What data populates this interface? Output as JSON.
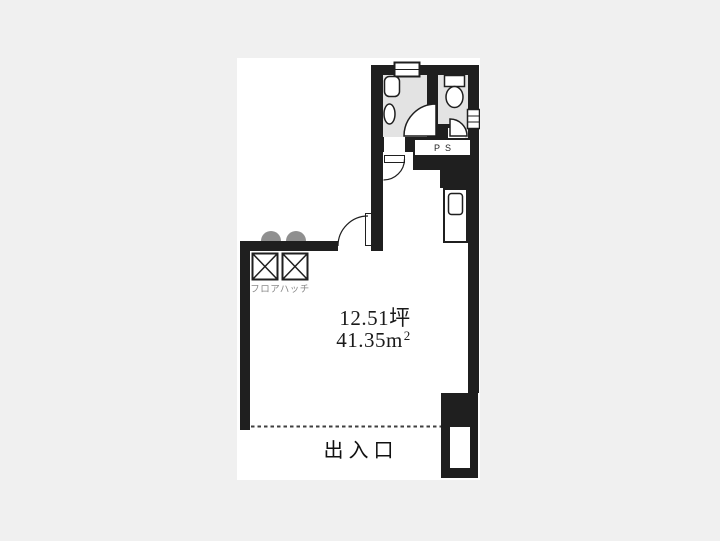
{
  "floorplan": {
    "area": {
      "tsubo_value": "12.51",
      "tsubo_unit": "坪",
      "sqm_value": "41.35",
      "sqm_unit_base": "m",
      "sqm_unit_sup": "2"
    },
    "labels": {
      "entrance": "出入口",
      "floor_hatch": "フロアハッチ",
      "pipe_space": "PS"
    },
    "colors": {
      "page_background": "#f0f0f0",
      "plan_background": "#ffffff",
      "wall": "#1f1f1f",
      "room_fill": "#e3e3e3",
      "hatch_label_text": "#8a8a8a"
    }
  }
}
